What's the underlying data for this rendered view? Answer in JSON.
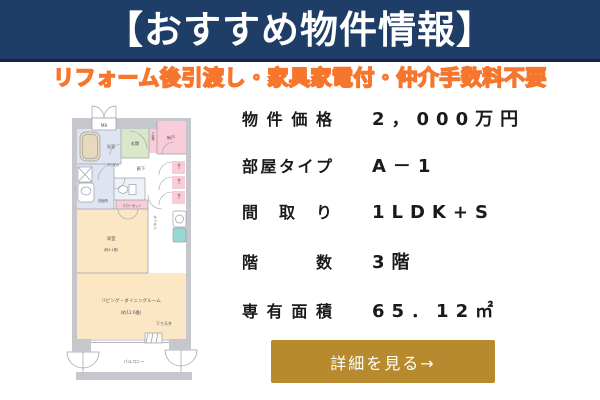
{
  "header": {
    "title": "【おすすめ物件情報】"
  },
  "subtitle": {
    "text": "リフォーム後引渡し・家具家電付・仲介手数料不要"
  },
  "specs": {
    "rows": [
      {
        "label": "物件価格",
        "value": "2，000万円"
      },
      {
        "label": "部屋タイプ",
        "value": "A－1"
      },
      {
        "label": "間取り",
        "value": "1LDK+S"
      },
      {
        "label": "階数",
        "value": "3階"
      },
      {
        "label": "専有面積",
        "value": "65．12㎡"
      }
    ]
  },
  "cta": {
    "label": "詳細を見る→"
  },
  "floorplan": {
    "labels": {
      "mb": "MB",
      "bath": "浴室",
      "entrance": "玄関",
      "shoe_cabinet": "下駄箱",
      "storage_room": "納戸",
      "hallway": "廊下",
      "closet_small": "物入",
      "lowered_ceiling_small": "下り天井",
      "washroom": "洗面所",
      "closet": "クローゼット",
      "western_room": "洋室",
      "western_room_size": "(約6.1畳)",
      "kitchen": "キッチン",
      "living_dining": "リビング・ダイニングルーム",
      "living_dining_size": "(約12.6畳)",
      "lowered_ceiling": "下り天井",
      "balcony": "バルコニー"
    },
    "colors": {
      "wall": "#c6c7cc",
      "fp_line": "#9aa0a8",
      "room_pink": "#f8ccd8",
      "room_green": "#d9e8c9",
      "room_lavender": "#dfe4f3",
      "room_peach": "#fce7c5",
      "toilet_floor": "#eef1f8",
      "fixture_teal": "#99d8d3",
      "tub_beige": "#e9d9bc"
    }
  },
  "colors": {
    "header_bg": "#1e3e68",
    "header_border": "#19224a",
    "subtitle_orange": "#f5762c",
    "cta_gold": "#b68a2d",
    "text_dark": "#1a1a1a"
  }
}
